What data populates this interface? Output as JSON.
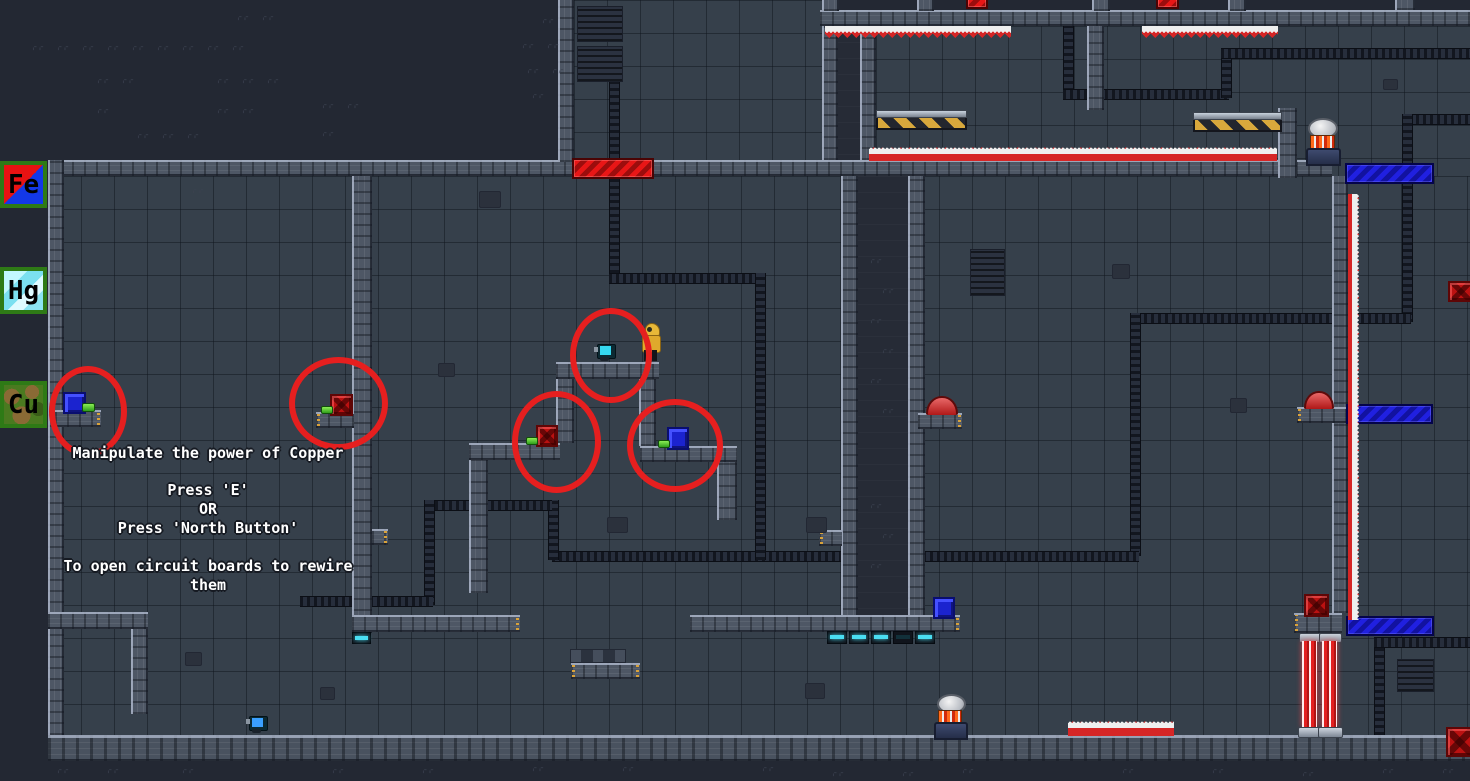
{
  "hud": {
    "badges": [
      {
        "symbol": "Fe",
        "element": "iron"
      },
      {
        "symbol": "Hg",
        "element": "mercury"
      },
      {
        "symbol": "Cu",
        "element": "copper"
      }
    ]
  },
  "tutorial": {
    "lines": [
      "Manipulate the power of Copper",
      "Press 'E'",
      "OR",
      "Press 'North Button'",
      "To open circuit boards to rewire",
      "them"
    ]
  },
  "colors": {
    "background": "#232833",
    "room_tile": "#36404b",
    "wall_stone": "#4e5765",
    "door_red": "#cf1414",
    "door_blue": "#1b22d8",
    "block_red": "#bb1111",
    "block_blue": "#1b23cf",
    "button_green": "#46c528",
    "button_red": "#c22424",
    "spike_red": "#d62626",
    "laser_red": "#e32020",
    "annotation_circle": "#e61f1f",
    "player_suit": "#e3ae33",
    "robot_cyan": "#3fd6ef",
    "vent_glow": "#4adef2",
    "hazard_yellow": "#d8a83c"
  }
}
